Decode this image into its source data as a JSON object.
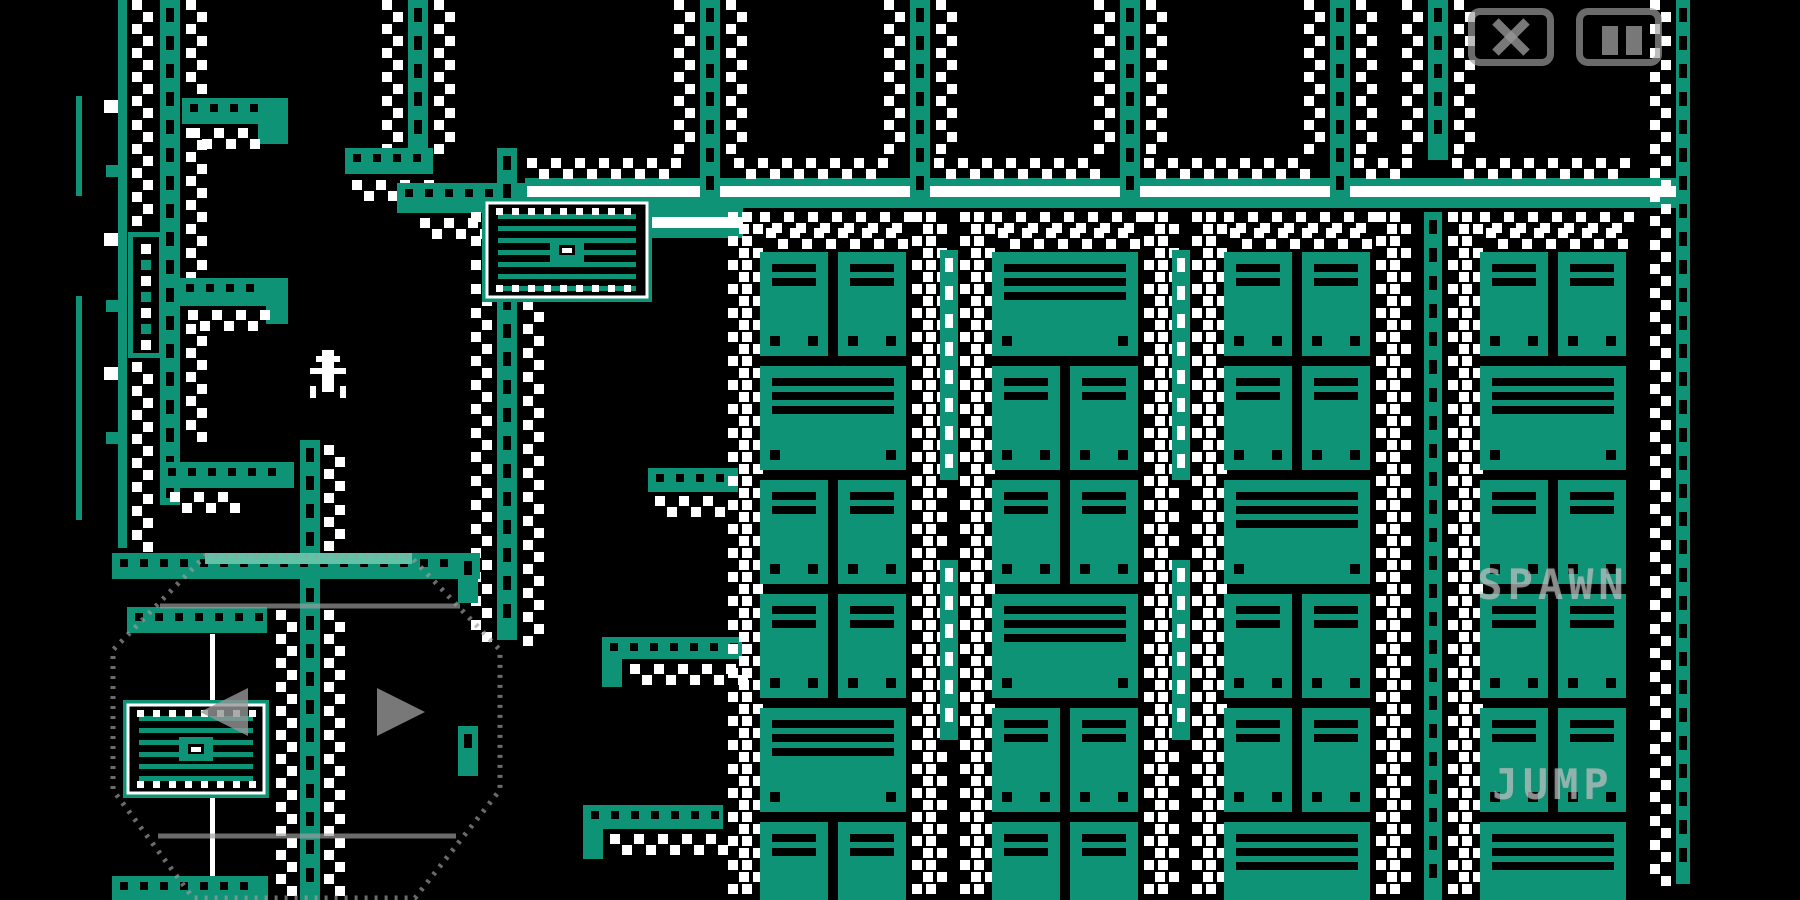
{
  "meta": {
    "width": 1800,
    "height": 900,
    "game_area_right": 1690
  },
  "colors": {
    "background": "#000000",
    "teal": "#0E9377",
    "light_teal": "#62C2A8",
    "white": "#FFFFFF",
    "overlay_stroke": "rgba(158,158,158,0.68)",
    "overlay_fill": "rgba(150,150,150,0.8)",
    "overlay_text": "rgba(208,212,212,0.58)"
  },
  "hud": {
    "spawn_button": {
      "label": "SPAWN",
      "x": 1553,
      "y": 560
    },
    "jump_button": {
      "label": "JUMP",
      "x": 1553,
      "y": 760
    },
    "close_button": {
      "x": 1468,
      "y": 8,
      "w": 86,
      "h": 58,
      "icon": "close-x"
    },
    "pause_button": {
      "x": 1576,
      "y": 8,
      "w": 86,
      "h": 58,
      "icon": "pause-bars"
    }
  },
  "joystick": {
    "outline": [
      [
        205,
        556
      ],
      [
        410,
        556
      ],
      [
        500,
        650
      ],
      [
        500,
        790
      ],
      [
        415,
        898
      ],
      [
        193,
        898
      ],
      [
        113,
        790
      ],
      [
        113,
        650
      ]
    ],
    "chords": [
      [
        160,
        606,
        460,
        606
      ],
      [
        158,
        836,
        456,
        836
      ]
    ],
    "arrow_left": [
      [
        200,
        712
      ],
      [
        248,
        688
      ],
      [
        248,
        736
      ]
    ],
    "arrow_right": [
      [
        425,
        712
      ],
      [
        377,
        688
      ],
      [
        377,
        736
      ]
    ]
  },
  "player": {
    "x": 310,
    "y": 350,
    "cell": 6,
    "pixels": [
      "..##..",
      ".####.",
      "..##..",
      "######",
      "..##..",
      "..##..",
      "#.##.#",
      "#....#"
    ]
  },
  "scene": [
    {
      "t": "band",
      "x": 525,
      "y": 178,
      "w": 1165,
      "h": 30,
      "sy": 8,
      "sh": 11
    },
    {
      "t": "band",
      "x": 525,
      "y": 208,
      "w": 218,
      "h": 30,
      "sy": 9,
      "sh": 11
    },
    {
      "t": "zigh",
      "x": 527,
      "y": 158,
      "w": 150
    },
    {
      "t": "zigh",
      "x": 734,
      "y": 158,
      "w": 152
    },
    {
      "t": "zigh",
      "x": 934,
      "y": 158,
      "w": 162
    },
    {
      "t": "zigh",
      "x": 1144,
      "y": 158,
      "w": 162
    },
    {
      "t": "zigh",
      "x": 1354,
      "y": 158,
      "w": 50
    },
    {
      "t": "zigh",
      "x": 1452,
      "y": 158,
      "w": 172
    },
    {
      "t": "vrail",
      "x": 700,
      "y": 0,
      "h": 208
    },
    {
      "t": "vrail",
      "x": 910,
      "y": 0,
      "h": 208
    },
    {
      "t": "vrail",
      "x": 1120,
      "y": 0,
      "h": 208
    },
    {
      "t": "vrail",
      "x": 1330,
      "y": 0,
      "h": 208
    },
    {
      "t": "vrail",
      "x": 1428,
      "y": 0,
      "h": 160
    },
    {
      "t": "vrail",
      "x": 1676,
      "y": 0,
      "h": 884,
      "w": 14
    },
    {
      "t": "zigv",
      "x": 674,
      "y": 0,
      "h": 156
    },
    {
      "t": "zigv",
      "x": 726,
      "y": 0,
      "h": 156
    },
    {
      "t": "zigv",
      "x": 884,
      "y": 0,
      "h": 156
    },
    {
      "t": "zigv",
      "x": 936,
      "y": 0,
      "h": 156
    },
    {
      "t": "zigv",
      "x": 1094,
      "y": 0,
      "h": 156
    },
    {
      "t": "zigv",
      "x": 1146,
      "y": 0,
      "h": 156
    },
    {
      "t": "zigv",
      "x": 1304,
      "y": 0,
      "h": 156
    },
    {
      "t": "zigv",
      "x": 1356,
      "y": 0,
      "h": 156
    },
    {
      "t": "zigv",
      "x": 1402,
      "y": 0,
      "h": 156
    },
    {
      "t": "zigv",
      "x": 1454,
      "y": 0,
      "h": 156
    },
    {
      "t": "zigv",
      "x": 1650,
      "y": 0,
      "h": 880
    },
    {
      "t": "vrail",
      "x": 408,
      "y": 0,
      "h": 150
    },
    {
      "t": "zigv",
      "x": 382,
      "y": 0,
      "h": 146
    },
    {
      "t": "zigv",
      "x": 434,
      "y": 0,
      "h": 146
    },
    {
      "t": "hplat",
      "x": 345,
      "y": 148,
      "w": 88,
      "h": 26
    },
    {
      "t": "zigh",
      "x": 352,
      "y": 180,
      "w": 76
    },
    {
      "t": "hplat",
      "x": 397,
      "y": 183,
      "w": 130,
      "h": 30
    },
    {
      "t": "zigh",
      "x": 420,
      "y": 218,
      "w": 84
    },
    {
      "t": "vrail",
      "x": 497,
      "y": 148,
      "h": 492
    },
    {
      "t": "zigv",
      "x": 471,
      "y": 212,
      "h": 426
    },
    {
      "t": "zigv",
      "x": 523,
      "y": 300,
      "h": 338
    },
    {
      "t": "rect",
      "x": 76,
      "y": 96,
      "w": 6,
      "h": 100,
      "f": "teal"
    },
    {
      "t": "rect",
      "x": 76,
      "y": 296,
      "w": 6,
      "h": 224,
      "f": "teal"
    },
    {
      "t": "rect",
      "x": 118,
      "y": 0,
      "w": 9,
      "h": 548,
      "f": "teal"
    },
    {
      "t": "rect",
      "x": 104,
      "y": 100,
      "w": 14,
      "h": 13,
      "f": "white"
    },
    {
      "t": "rect",
      "x": 104,
      "y": 233,
      "w": 14,
      "h": 13,
      "f": "white"
    },
    {
      "t": "rect",
      "x": 104,
      "y": 367,
      "w": 14,
      "h": 13,
      "f": "white"
    },
    {
      "t": "rect",
      "x": 106,
      "y": 165,
      "w": 12,
      "h": 12,
      "f": "teal"
    },
    {
      "t": "rect",
      "x": 106,
      "y": 300,
      "w": 12,
      "h": 12,
      "f": "teal"
    },
    {
      "t": "rect",
      "x": 106,
      "y": 432,
      "w": 12,
      "h": 12,
      "f": "teal"
    },
    {
      "t": "zigv",
      "x": 132,
      "y": 0,
      "h": 228
    },
    {
      "t": "zigv",
      "x": 132,
      "y": 362,
      "h": 184
    },
    {
      "t": "cartridge",
      "x": 128,
      "y": 232,
      "w": 36,
      "h": 126
    },
    {
      "t": "vrail",
      "x": 160,
      "y": 0,
      "h": 505
    },
    {
      "t": "zigv",
      "x": 186,
      "y": 0,
      "h": 92
    },
    {
      "t": "zigv",
      "x": 186,
      "y": 128,
      "h": 150
    },
    {
      "t": "zigv",
      "x": 186,
      "y": 324,
      "h": 118
    },
    {
      "t": "hplat",
      "x": 182,
      "y": 98,
      "w": 106,
      "h": 26
    },
    {
      "t": "rect",
      "x": 258,
      "y": 98,
      "w": 30,
      "h": 46,
      "f": "teal"
    },
    {
      "t": "zigh",
      "x": 190,
      "y": 128,
      "w": 66
    },
    {
      "t": "hplat",
      "x": 178,
      "y": 278,
      "w": 110,
      "h": 28
    },
    {
      "t": "rect",
      "x": 266,
      "y": 278,
      "w": 22,
      "h": 46,
      "f": "teal"
    },
    {
      "t": "zigh",
      "x": 188,
      "y": 310,
      "w": 76
    },
    {
      "t": "hplat",
      "x": 160,
      "y": 462,
      "w": 134,
      "h": 26
    },
    {
      "t": "zigh",
      "x": 170,
      "y": 492,
      "w": 70
    },
    {
      "t": "vrail",
      "x": 300,
      "y": 440,
      "h": 460
    },
    {
      "t": "zigv",
      "x": 324,
      "y": 445,
      "h": 112
    },
    {
      "t": "zigv",
      "x": 276,
      "y": 610,
      "h": 278
    },
    {
      "t": "zigv",
      "x": 324,
      "y": 610,
      "h": 278
    },
    {
      "t": "hplat",
      "x": 112,
      "y": 553,
      "w": 368,
      "h": 26
    },
    {
      "t": "rect",
      "x": 205,
      "y": 553,
      "w": 207,
      "h": 11,
      "f": "light"
    },
    {
      "t": "vrail",
      "x": 458,
      "y": 553,
      "h": 50
    },
    {
      "t": "vrail",
      "x": 458,
      "y": 726,
      "h": 50
    },
    {
      "t": "hplat",
      "x": 127,
      "y": 607,
      "w": 140,
      "h": 26
    },
    {
      "t": "rect",
      "x": 210,
      "y": 634,
      "w": 5,
      "h": 242,
      "f": "white"
    },
    {
      "t": "grate",
      "x": 123,
      "y": 700,
      "w": 146,
      "h": 98
    },
    {
      "t": "hplat",
      "x": 112,
      "y": 876,
      "w": 156,
      "h": 24
    },
    {
      "t": "hplat",
      "x": 602,
      "y": 637,
      "w": 140,
      "h": 22
    },
    {
      "t": "rect",
      "x": 602,
      "y": 659,
      "w": 20,
      "h": 28,
      "f": "teal"
    },
    {
      "t": "zigh",
      "x": 630,
      "y": 664,
      "w": 112
    },
    {
      "t": "hplat",
      "x": 583,
      "y": 805,
      "w": 140,
      "h": 24
    },
    {
      "t": "rect",
      "x": 583,
      "y": 829,
      "w": 20,
      "h": 30,
      "f": "teal"
    },
    {
      "t": "zigh",
      "x": 610,
      "y": 834,
      "w": 112
    },
    {
      "t": "hplat",
      "x": 648,
      "y": 468,
      "w": 90,
      "h": 24
    },
    {
      "t": "zigh",
      "x": 655,
      "y": 496,
      "w": 66
    },
    {
      "t": "grate",
      "x": 482,
      "y": 198,
      "w": 170,
      "h": 104
    },
    {
      "t": "stack",
      "x": 726,
      "pw": 146,
      "rows": [
        2,
        1,
        2,
        2,
        1,
        2
      ]
    },
    {
      "t": "stack",
      "x": 958,
      "pw": 146,
      "rows": [
        1,
        2,
        2,
        1,
        2,
        2
      ]
    },
    {
      "t": "stack",
      "x": 1190,
      "pw": 146,
      "rows": [
        2,
        2,
        1,
        2,
        2,
        1
      ]
    },
    {
      "t": "stack",
      "x": 1446,
      "pw": 146,
      "rows": [
        2,
        1,
        2,
        2,
        2,
        1
      ],
      "nozr": true
    },
    {
      "t": "vrail",
      "x": 940,
      "y": 250,
      "h": 230,
      "w": 18,
      "ws": true
    },
    {
      "t": "vrail",
      "x": 940,
      "y": 560,
      "h": 180,
      "w": 18,
      "ws": true
    },
    {
      "t": "vrail",
      "x": 1172,
      "y": 250,
      "h": 230,
      "w": 18,
      "ws": true
    },
    {
      "t": "vrail",
      "x": 1172,
      "y": 560,
      "h": 180,
      "w": 18,
      "ws": true
    },
    {
      "t": "vrail",
      "x": 1424,
      "y": 212,
      "h": 688,
      "w": 18
    }
  ]
}
